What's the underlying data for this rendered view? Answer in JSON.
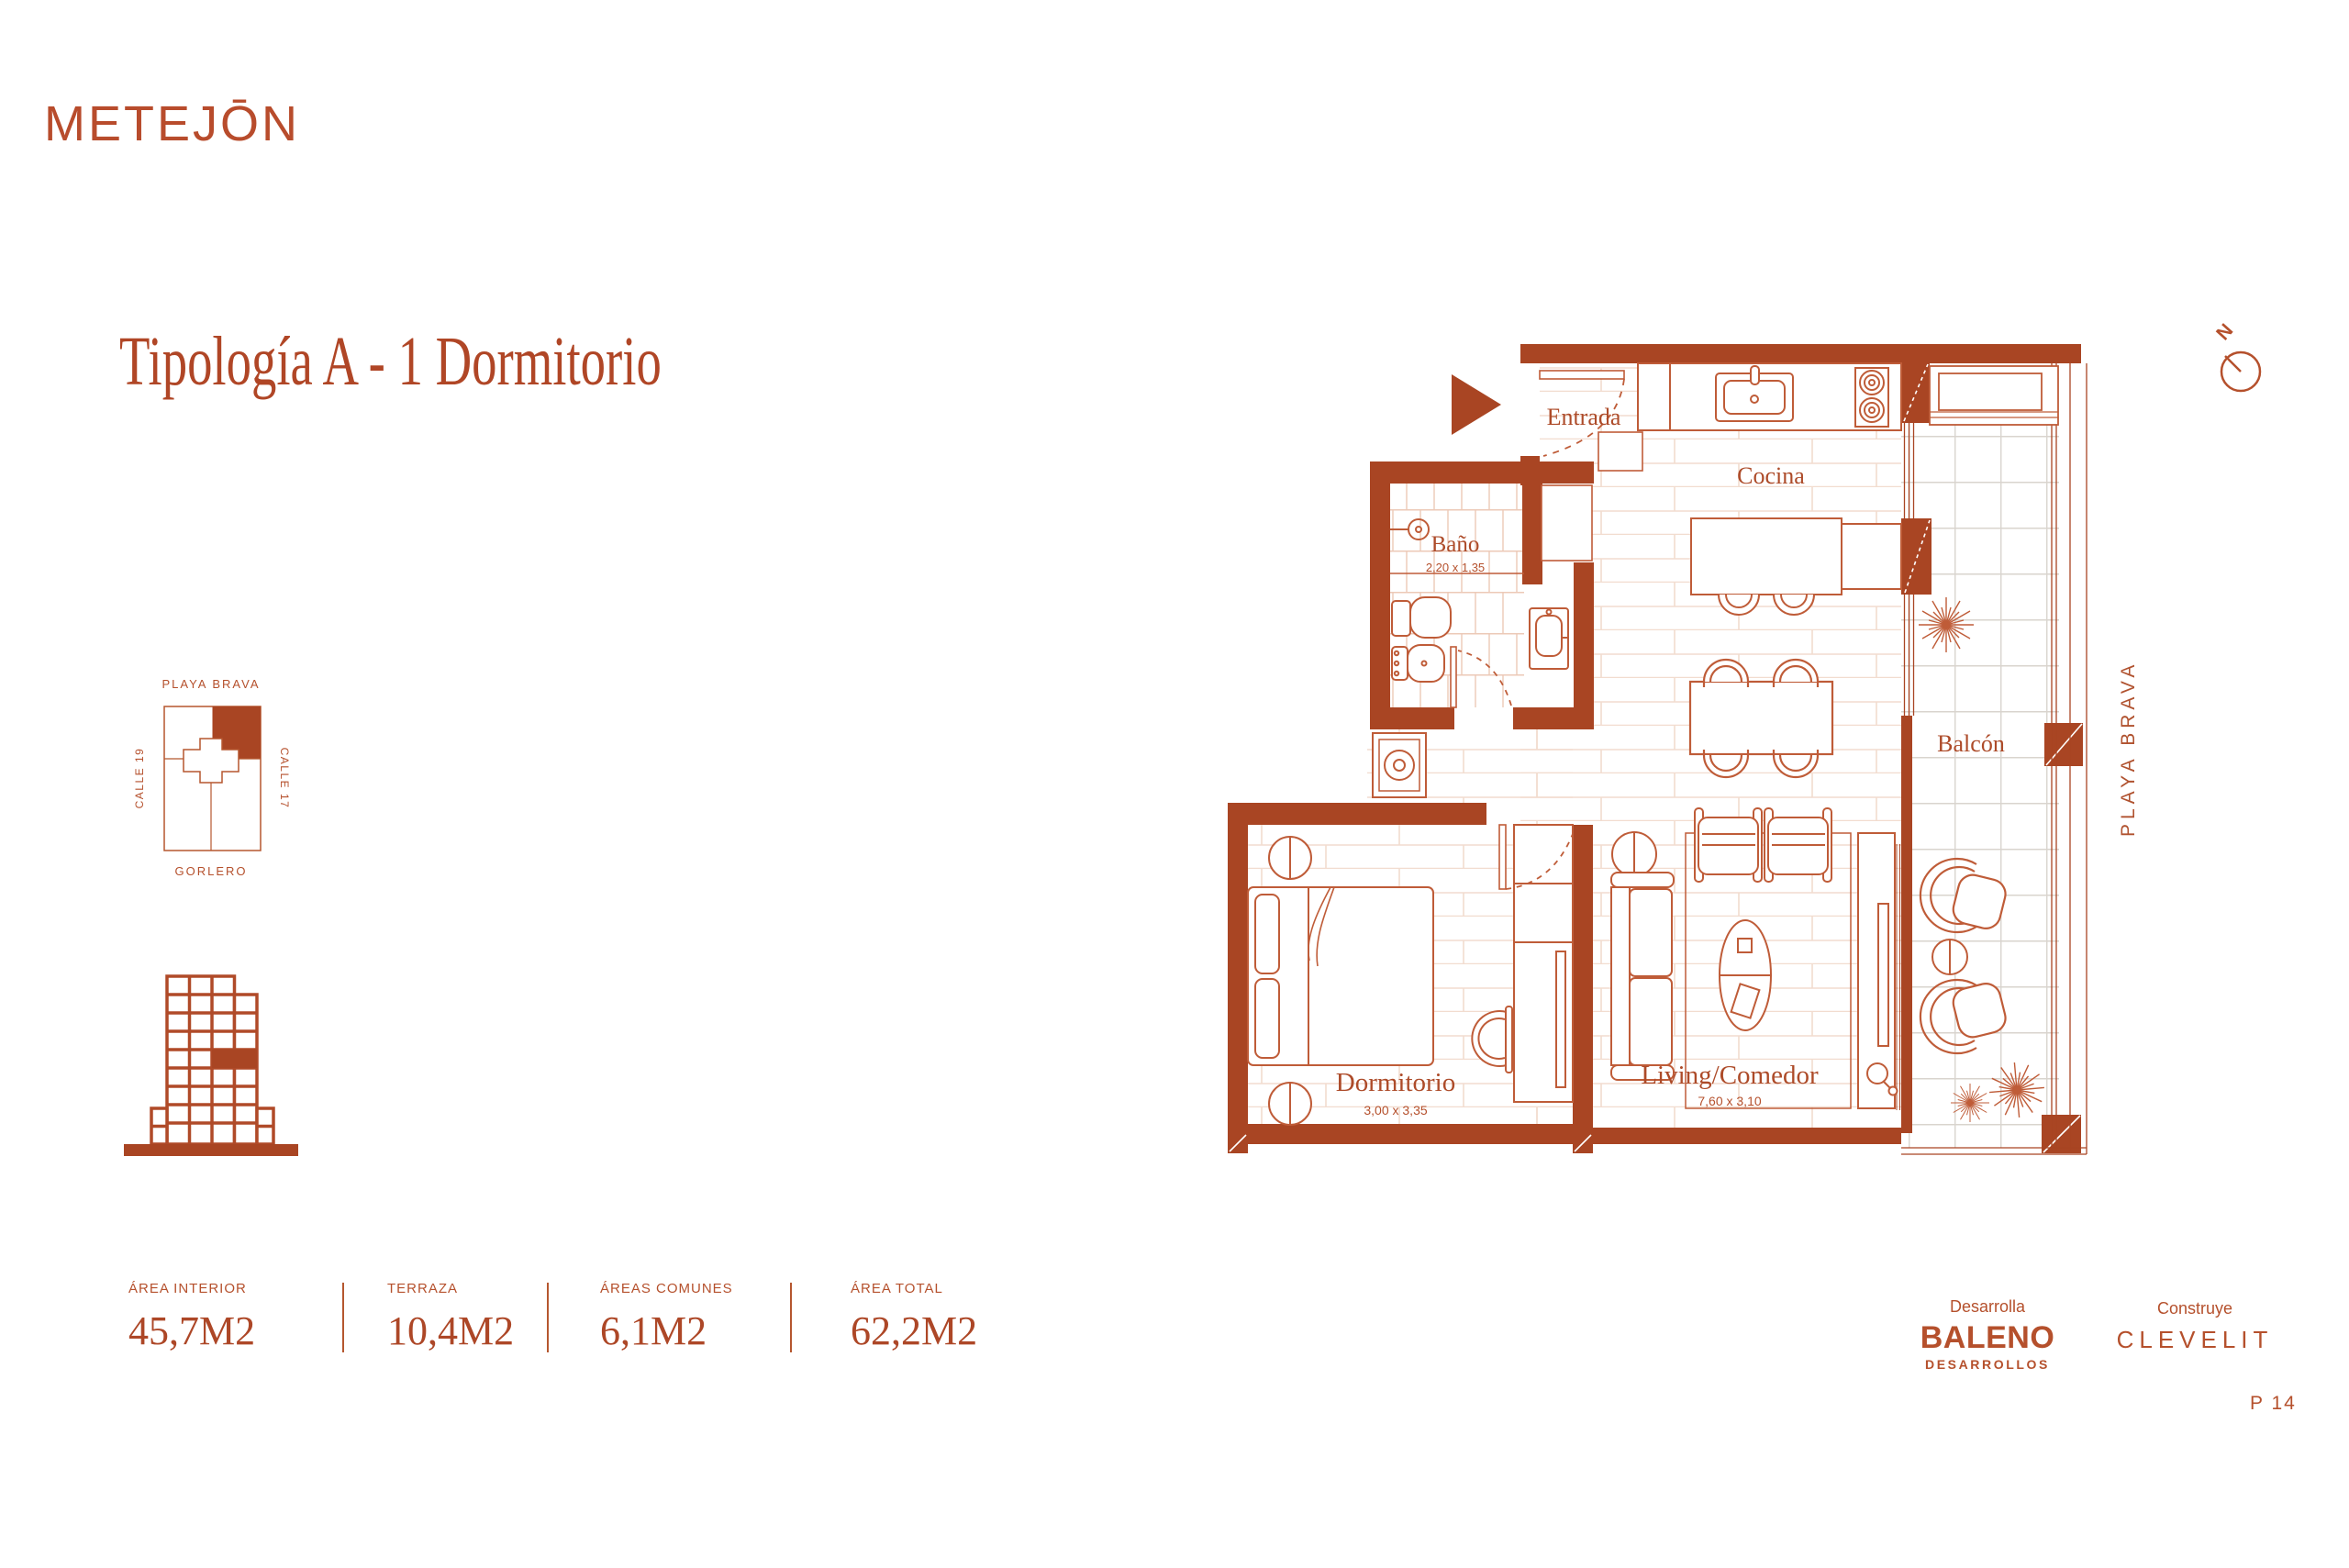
{
  "brand": {
    "logo_text": "METEJŌN"
  },
  "page": {
    "title": "Tipología A - 1 Dormitorio",
    "page_number": "P 14"
  },
  "site_map": {
    "top_label": "PLAYA BRAVA",
    "left_label": "CALLE 19",
    "right_label": "CALLE 17",
    "bottom_label": "GORLERO"
  },
  "floor_plan": {
    "labels": {
      "entrada": "Entrada",
      "cocina": "Cocina",
      "bano": "Baño",
      "bano_dims": "2,20 x 1,35",
      "balcon": "Balcón",
      "dormitorio": "Dormitorio",
      "dormitorio_dims": "3,00 x 3,35",
      "living": "Living/Comedor",
      "living_dims": "7,60 x 3,10",
      "street": "PLAYA BRAVA",
      "north": "N"
    }
  },
  "areas": {
    "items": [
      {
        "label": "ÁREA INTERIOR",
        "value": "45,7M2"
      },
      {
        "label": "TERRAZA",
        "value": "10,4M2"
      },
      {
        "label": "ÁREAS COMUNES",
        "value": "6,1M2"
      },
      {
        "label": "ÁREA TOTAL",
        "value": "62,2M2"
      }
    ]
  },
  "footer": {
    "developer_caption": "Desarrolla",
    "developer_name": "BALENO",
    "developer_sub": "DESARROLLOS",
    "builder_caption": "Construye",
    "builder_name": "CLEVELIT"
  },
  "colors": {
    "terracotta": "#b34a29",
    "wall": "#a94523",
    "line": "#bf5c38"
  }
}
